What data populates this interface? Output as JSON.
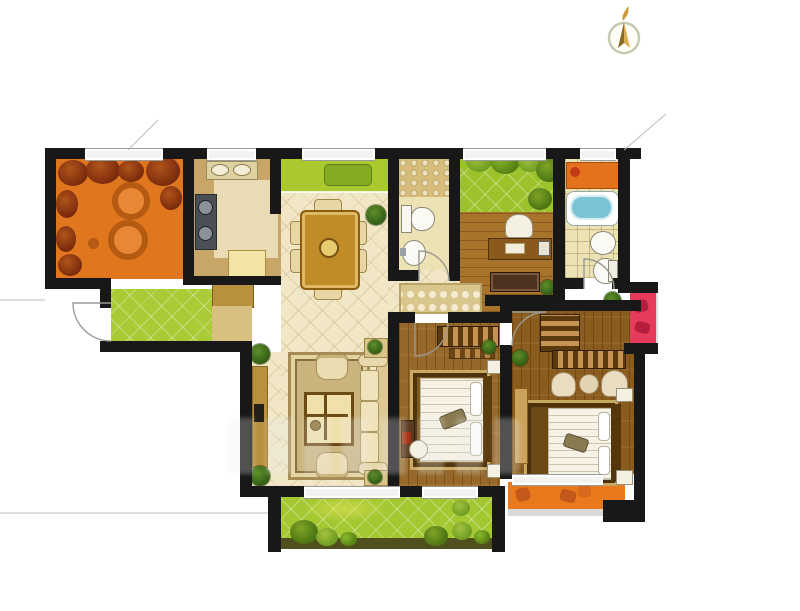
{
  "title": "three-bedroom-apartment-floor-plan",
  "compass": {
    "icon": "north-arrow-icon"
  },
  "watermark": {
    "visible": true,
    "legible": false
  },
  "palette": {
    "wall": "#181818",
    "terrace_orange": "#e0761e",
    "foliage_red": "#8a3010",
    "kitchen_tan": "#c7a668",
    "kitchen_tile": "#e9dcb4",
    "counter_yellow": "#f2e4a6",
    "tile_cream": "#f1e7c6",
    "bay_green": "#a9c92f",
    "bench_green": "#84aa24",
    "table_gold": "#c08c28",
    "bath_cream": "#ece2b4",
    "pebble_tan": "#d6bd7c",
    "garden_green": "#9cc32b",
    "entry_green": "#aacb36",
    "lawn_green": "#a3c832",
    "study_wood": "#a8732b",
    "bedroom_wood": "#96682a",
    "master_wood": "#8a5c1e",
    "tub_blue": "#79c4d4",
    "cabinet_orange": "#e4711b",
    "accent_red": "#e73b5b",
    "balcony_orange": "#e8791c",
    "shoe_cabinet_gold": "#b8913f",
    "runner_beige": "#d8c68c"
  },
  "rooms": [
    {
      "id": "north-terrace",
      "type": "balcony",
      "features": [
        "climbing-plants",
        "lounge-chairs"
      ]
    },
    {
      "id": "kitchen",
      "type": "room",
      "features": [
        "sink",
        "stove",
        "tiled-counter-floor",
        "refrigerator"
      ]
    },
    {
      "id": "dining-room",
      "type": "room",
      "features": [
        "bay-window-bench",
        "dining-table",
        "six-chairs",
        "potted-plant"
      ]
    },
    {
      "id": "guest-bathroom",
      "type": "room",
      "features": [
        "shower-area",
        "toilet",
        "washbasin"
      ]
    },
    {
      "id": "roof-garden",
      "type": "garden",
      "features": [
        "lawn",
        "shrubs"
      ]
    },
    {
      "id": "study",
      "type": "room",
      "features": [
        "desk",
        "chair",
        "bookshelf",
        "plant"
      ]
    },
    {
      "id": "master-bathroom",
      "type": "room",
      "features": [
        "storage-cabinet",
        "bathtub",
        "washbasin",
        "toilet"
      ]
    },
    {
      "id": "entry",
      "type": "room",
      "features": [
        "entry-garden",
        "shoe-cabinet",
        "doormat",
        "entry-door"
      ]
    },
    {
      "id": "hallway",
      "type": "room",
      "features": [
        "runner-rug"
      ]
    },
    {
      "id": "living-room",
      "type": "room",
      "features": [
        "tv-cabinet",
        "rug",
        "coffee-table",
        "sofa",
        "armchairs",
        "corner-plants"
      ]
    },
    {
      "id": "bedroom-two",
      "type": "room",
      "features": [
        "wardrobe",
        "double-bed",
        "nightstands",
        "tv-stand",
        "chair",
        "plant"
      ]
    },
    {
      "id": "master-bedroom",
      "type": "room",
      "features": [
        "l-shaped-wardrobe",
        "stools",
        "double-bed",
        "dresser",
        "nightstands",
        "plants"
      ]
    },
    {
      "id": "south-balcony",
      "type": "balcony",
      "features": [
        "lawn",
        "shrubs"
      ]
    },
    {
      "id": "master-balcony",
      "type": "balcony",
      "features": [
        "orange-planters"
      ]
    },
    {
      "id": "flower-box",
      "type": "exterior",
      "features": [
        "red-planter"
      ]
    }
  ]
}
